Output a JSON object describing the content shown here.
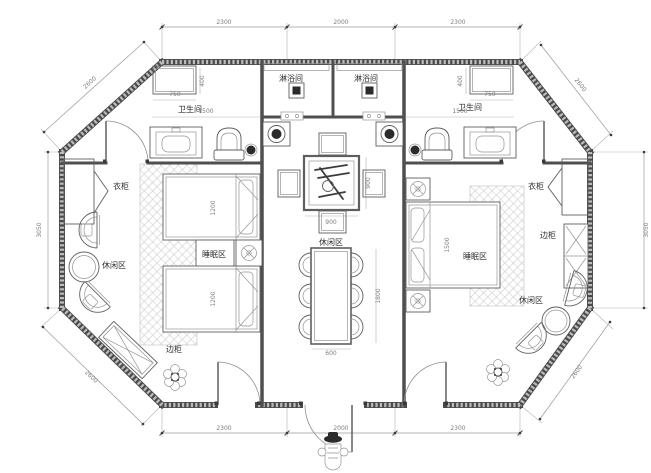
{
  "drawing": {
    "type": "floor-plan",
    "units": "mm",
    "colors": {
      "background": "#ffffff",
      "wall": "#4a4a4a",
      "wall_fill": "#bcbcbc",
      "line": "#5f5f5f",
      "hatch": "#c9c9c9",
      "room_text": "#2f2f2f",
      "dim_text": "#7d7d7d"
    },
    "room_labels": [
      {
        "id": "label-shower-room-left",
        "text": "淋浴间",
        "x": 291,
        "y": 81
      },
      {
        "id": "label-shower-room-right",
        "text": "淋浴间",
        "x": 366,
        "y": 81
      },
      {
        "id": "label-bathroom-left",
        "text": "卫生间",
        "x": 190,
        "y": 112
      },
      {
        "id": "label-bathroom-right",
        "text": "卫生间",
        "x": 470,
        "y": 110
      },
      {
        "id": "label-wardrobe-left",
        "text": "衣柜",
        "x": 121,
        "y": 189
      },
      {
        "id": "label-wardrobe-right",
        "text": "衣柜",
        "x": 536,
        "y": 189
      },
      {
        "id": "label-sleeping-area-left",
        "text": "睡眠区",
        "x": 214,
        "y": 257
      },
      {
        "id": "label-sleeping-area-right",
        "text": "睡眠区",
        "x": 475,
        "y": 259
      },
      {
        "id": "label-leisure-area-left",
        "text": "休闲区",
        "x": 114,
        "y": 268
      },
      {
        "id": "label-leisure-area-center",
        "text": "休闲区",
        "x": 331,
        "y": 245
      },
      {
        "id": "label-leisure-area-right",
        "text": "休闲区",
        "x": 531,
        "y": 303
      },
      {
        "id": "label-side-cabinet-left",
        "text": "边柜",
        "x": 174,
        "y": 352
      },
      {
        "id": "label-side-cabinet-right",
        "text": "边柜",
        "x": 548,
        "y": 238
      }
    ],
    "dimensions": [
      {
        "id": "dim-top-left",
        "text": "2300",
        "x": 224,
        "y": 24
      },
      {
        "id": "dim-top-center",
        "text": "2000",
        "x": 341,
        "y": 24
      },
      {
        "id": "dim-top-right",
        "text": "2300",
        "x": 458,
        "y": 24
      },
      {
        "id": "dim-bottom-left",
        "text": "2300",
        "x": 224,
        "y": 430
      },
      {
        "id": "dim-bottom-center",
        "text": "2000",
        "x": 341,
        "y": 430
      },
      {
        "id": "dim-bottom-right",
        "text": "2300",
        "x": 458,
        "y": 430
      },
      {
        "id": "dim-side-left",
        "text": "3050",
        "x": 41,
        "y": 230,
        "r": -90
      },
      {
        "id": "dim-side-right",
        "text": "3050",
        "x": 648,
        "y": 230,
        "r": -90
      },
      {
        "id": "dim-diagonal-top-left",
        "text": "2600",
        "x": 91,
        "y": 84,
        "r": -42
      },
      {
        "id": "dim-diagonal-top-right",
        "text": "2600",
        "x": 579,
        "y": 86,
        "r": 52
      },
      {
        "id": "dim-diagonal-bottom-left",
        "text": "2600",
        "x": 90,
        "y": 378,
        "r": 44
      },
      {
        "id": "dim-diagonal-bottom-right",
        "text": "2600",
        "x": 578,
        "y": 373,
        "r": -54
      },
      {
        "id": "dim-shelf-left",
        "text": "750",
        "x": 175,
        "y": 96
      },
      {
        "id": "dim-shelf-right",
        "text": "750",
        "x": 490,
        "y": 96
      },
      {
        "id": "dim-shelf-depth-left",
        "text": "400",
        "x": 204,
        "y": 81,
        "r": -90
      },
      {
        "id": "dim-shelf-depth-right",
        "text": "400",
        "x": 462,
        "y": 81,
        "r": -90
      },
      {
        "id": "dim-bathroom-left",
        "text": "1500",
        "x": 206,
        "y": 113
      },
      {
        "id": "dim-bathroom-right",
        "text": "1500",
        "x": 460,
        "y": 113
      },
      {
        "id": "dim-tea-table-width",
        "text": "900",
        "x": 331,
        "y": 224
      },
      {
        "id": "dim-tea-table-height",
        "text": "900",
        "x": 370,
        "y": 183,
        "r": -90
      },
      {
        "id": "dim-dining-length",
        "text": "1800",
        "x": 380,
        "y": 296,
        "r": -90
      },
      {
        "id": "dim-dining-width",
        "text": "600",
        "x": 331,
        "y": 355
      },
      {
        "id": "dim-bed1-left",
        "text": "1200",
        "x": 215,
        "y": 208,
        "r": -90
      },
      {
        "id": "dim-bed2-left",
        "text": "1200",
        "x": 215,
        "y": 299,
        "r": -90
      },
      {
        "id": "dim-bed-right",
        "text": "1500",
        "x": 449,
        "y": 245,
        "r": -90
      }
    ]
  }
}
